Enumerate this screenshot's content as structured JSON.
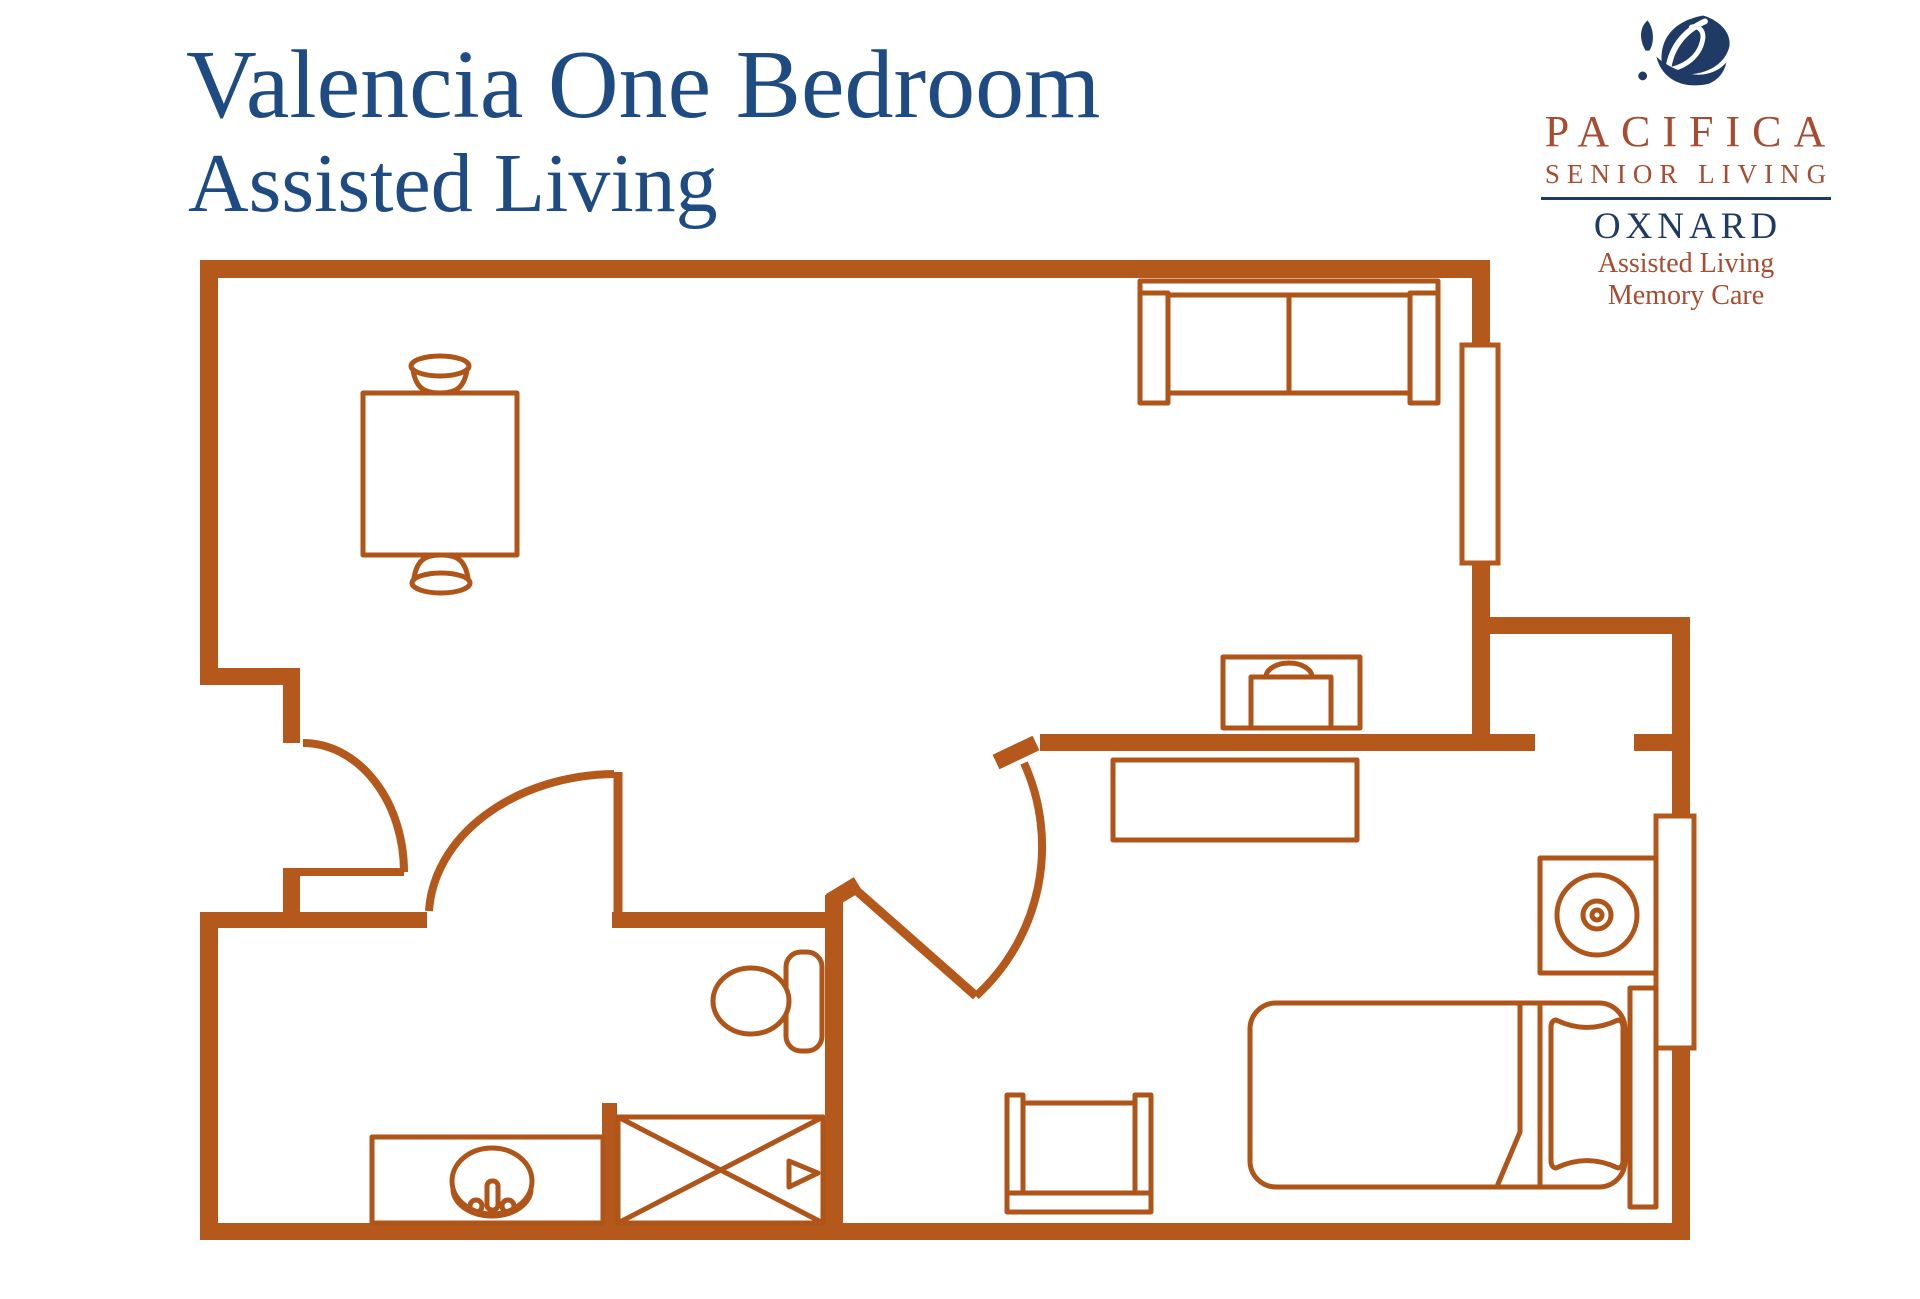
{
  "header": {
    "title": "Valencia One Bedroom",
    "subtitle": "Assisted Living"
  },
  "logo": {
    "icon": "leaf-icon",
    "brand": "PACIFICA",
    "tagline": "SENIOR LIVING",
    "location": "OXNARD",
    "services": [
      "Assisted Living",
      "Memory Care"
    ]
  },
  "colors": {
    "wall": "#b4591b",
    "furniture": "#b05519",
    "title_blue": "#1d4b82",
    "logo_navy": "#203a66",
    "logo_rust": "#a74c30",
    "background": "#ffffff"
  },
  "floorplan": {
    "rooms": [
      "living-dining-area",
      "bedroom",
      "bathroom",
      "closet",
      "entry"
    ],
    "windows": 2,
    "doors": [
      "entry-door",
      "bathroom-door",
      "bedroom-door"
    ],
    "furniture": [
      "dining-table",
      "dining-chair",
      "dining-chair",
      "sofa",
      "accent-chair",
      "media-dresser",
      "nightstand-with-lamp",
      "bed",
      "pillow",
      "headboard",
      "toilet",
      "vanity-sink",
      "shower",
      "bench"
    ]
  }
}
